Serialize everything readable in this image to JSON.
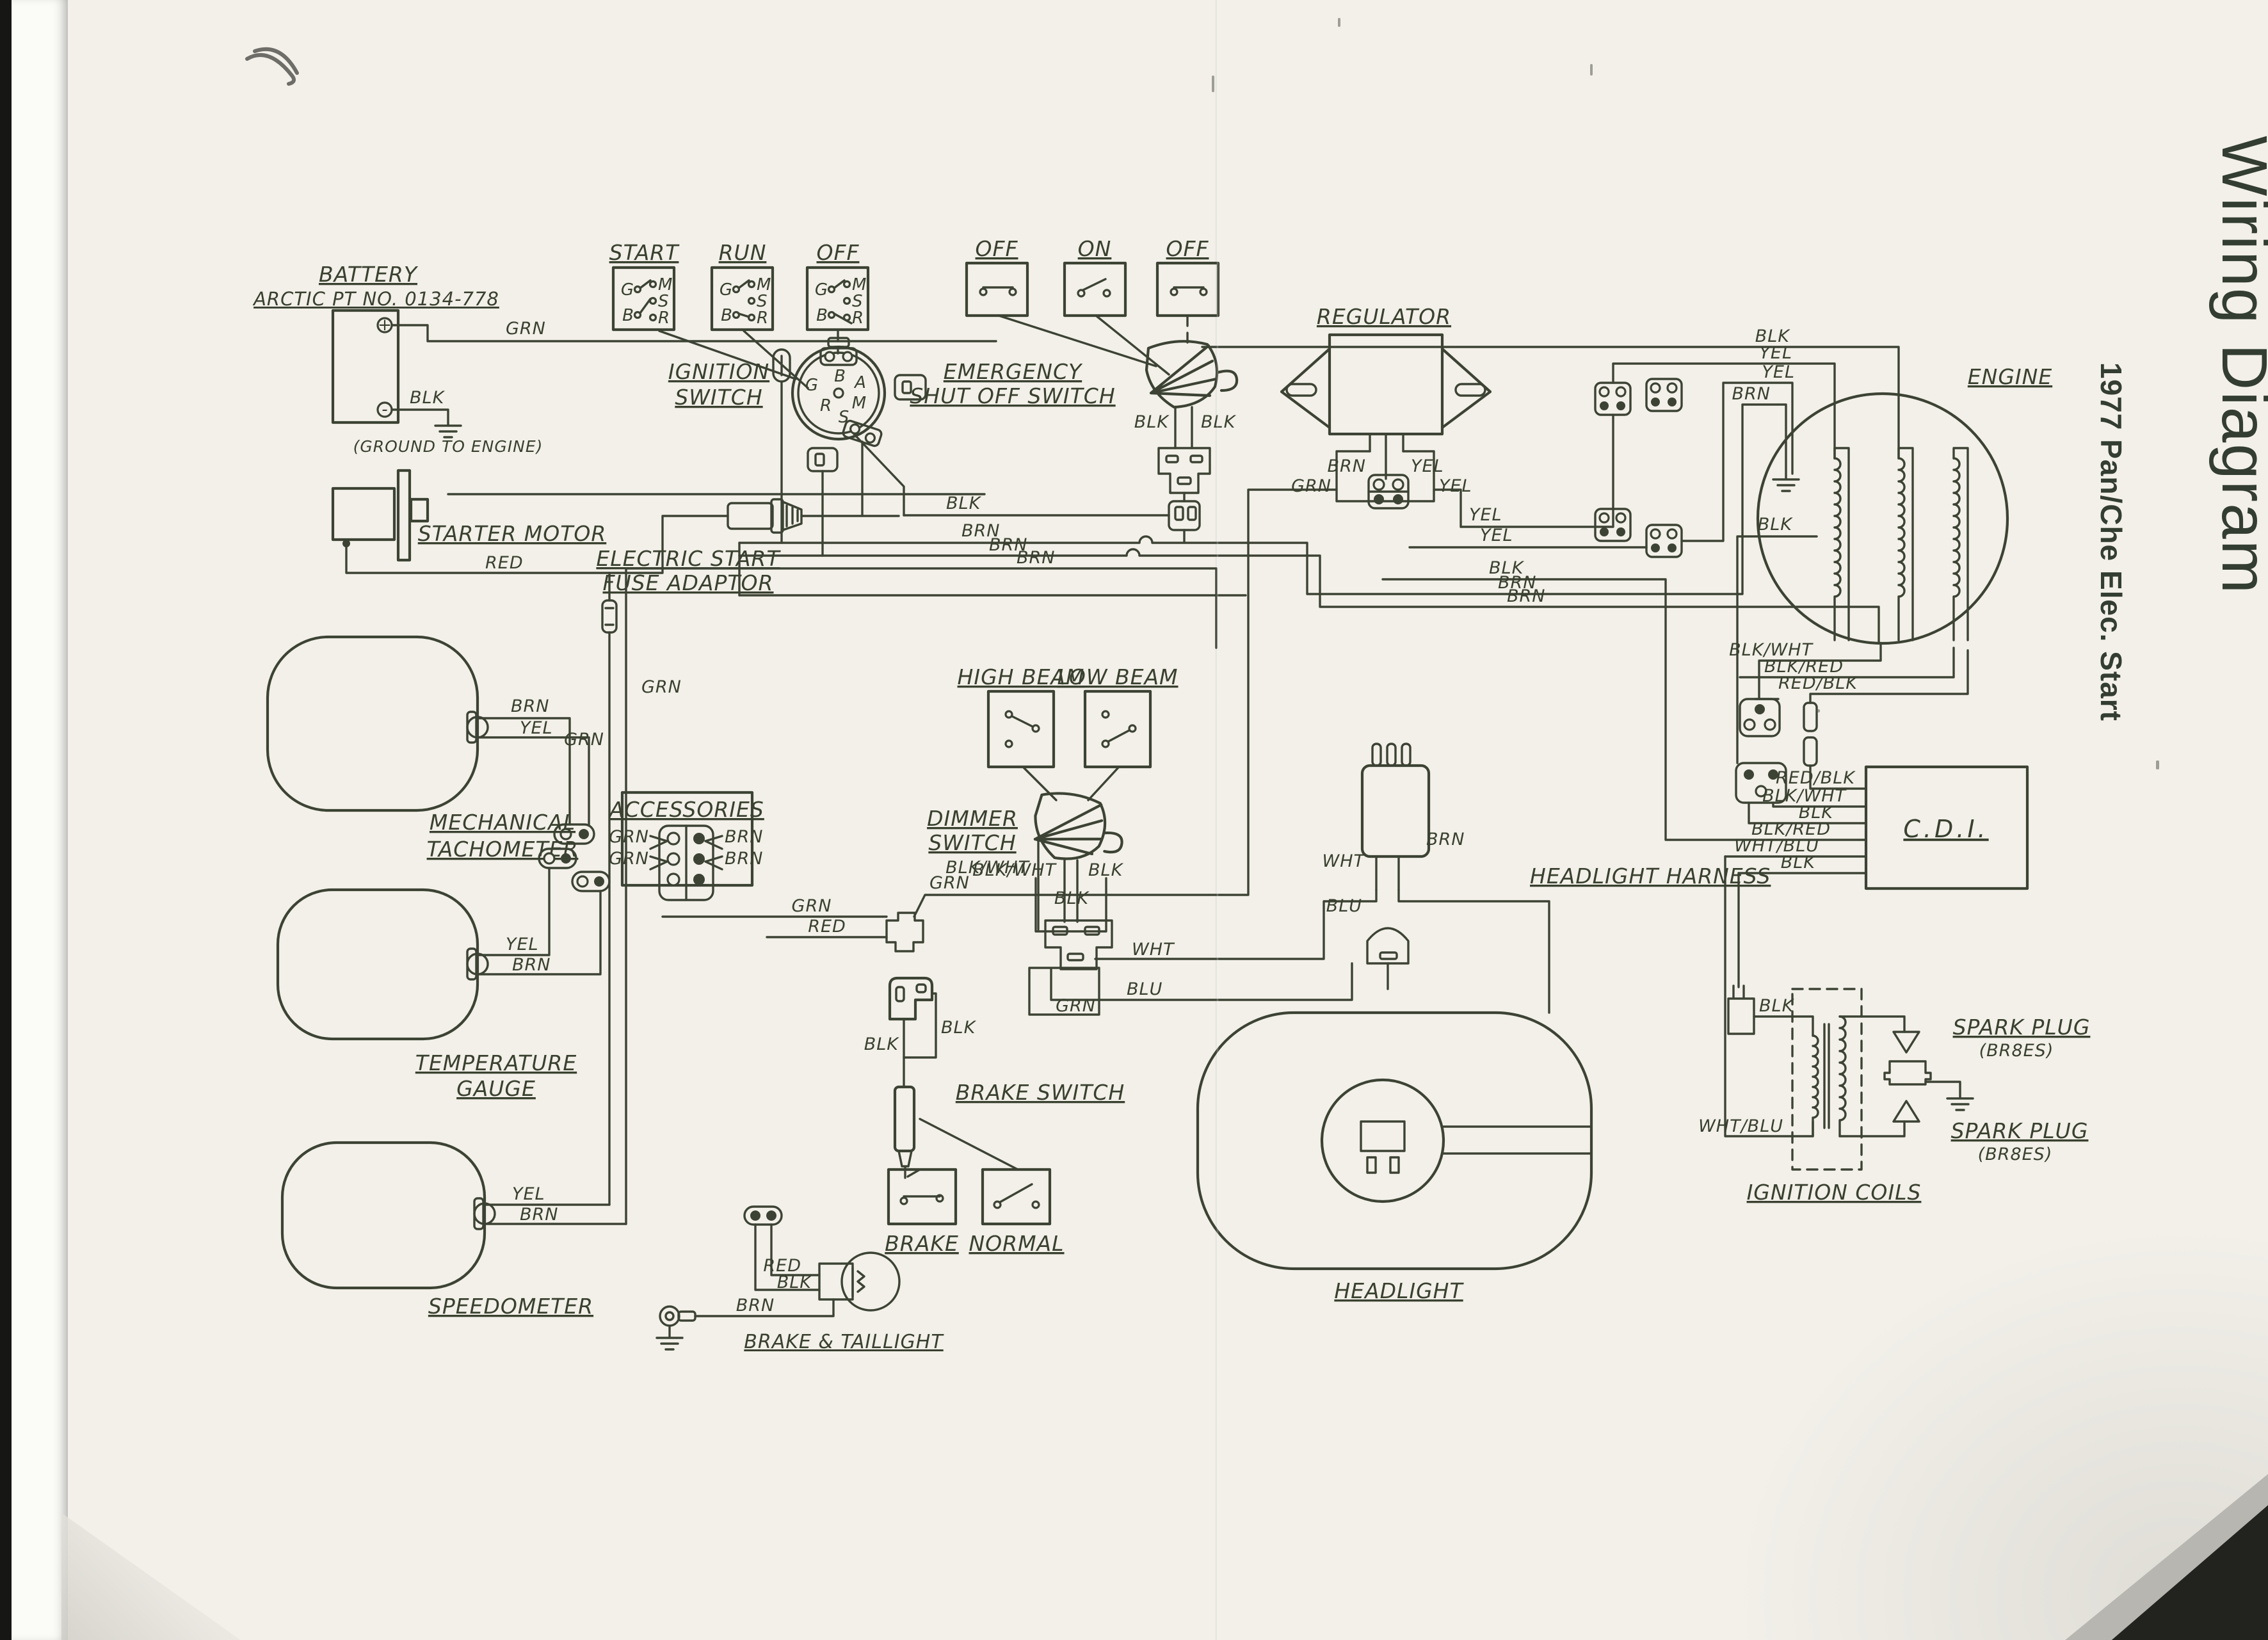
{
  "page": {
    "title_main": "Wiring Diagram",
    "title_sub": "1977 Pan/Che Elec. Start"
  },
  "battery": {
    "name": "BATTERY",
    "part": "ARCTIC PT NO. 0134-778",
    "plus": "+",
    "minus": "-",
    "wire_grn": "GRN",
    "wire_blk": "BLK",
    "ground_note": "(GROUND TO ENGINE)"
  },
  "key_positions": {
    "start": "START",
    "run": "RUN",
    "off": "OFF",
    "t_g": "G",
    "t_b": "B",
    "t_m": "M",
    "t_s": "S",
    "t_r": "R"
  },
  "ignition": {
    "line1": "IGNITION",
    "line2": "SWITCH",
    "t_b": "B",
    "t_g": "G",
    "t_a": "A",
    "t_m": "M",
    "t_r": "R",
    "t_s": "S"
  },
  "emergency": {
    "off1": "OFF",
    "on": "ON",
    "off2": "OFF",
    "line1": "EMERGENCY",
    "line2": "SHUT OFF SWITCH",
    "blk_l": "BLK",
    "blk_r": "BLK"
  },
  "starter": {
    "name": "STARTER MOTOR",
    "red": "RED"
  },
  "fuse_adaptor": {
    "line1": "ELECTRIC START",
    "line2": "FUSE ADAPTOR"
  },
  "regulator": {
    "name": "REGULATOR",
    "brn": "BRN",
    "yel_pin": "YEL",
    "grn": "GRN",
    "yel": "YEL"
  },
  "bundle": {
    "yel1": "YEL",
    "yel2": "YEL",
    "blk": "BLK",
    "brn1": "BRN",
    "brn2": "BRN"
  },
  "bus": {
    "blk": "BLK",
    "brn1": "BRN",
    "brn2": "BRN",
    "brn3": "BRN"
  },
  "engine": {
    "name": "ENGINE",
    "blk_top": "BLK",
    "yel1": "YEL",
    "yel2": "YEL",
    "brn": "BRN",
    "blk_low": "BLK"
  },
  "cdi": {
    "name": "C.D.I.",
    "up1": "BLK/WHT",
    "up2": "BLK/RED",
    "up3": "RED/BLK",
    "in1": "RED/BLK",
    "in2": "BLK/WHT",
    "in3": "BLK",
    "in4": "BLK/RED",
    "in5": "WHT/BLU",
    "in6": "BLK"
  },
  "coils": {
    "name": "IGNITION COILS",
    "blk": "BLK",
    "wht_blu": "WHT/BLU",
    "sp1a": "SPARK PLUG",
    "sp1b": "(BR8ES)",
    "sp2a": "SPARK PLUG",
    "sp2b": "(BR8ES)"
  },
  "tach": {
    "line1": "MECHANICAL",
    "line2": "TACHOMETER",
    "brn": "BRN",
    "yel": "YEL"
  },
  "temp": {
    "line1": "TEMPERATURE",
    "line2": "GAUGE",
    "yel": "YEL",
    "brn": "BRN"
  },
  "speedo": {
    "name": "SPEEDOMETER",
    "yel": "YEL",
    "brn": "BRN"
  },
  "left_bus": {
    "grn1": "GRN",
    "grn2": "GRN"
  },
  "accessories": {
    "name": "ACCESSORIES",
    "grn1": "GRN",
    "grn2": "GRN",
    "brn1": "BRN",
    "brn2": "BRN"
  },
  "mid": {
    "grn": "GRN",
    "red": "RED",
    "grn2": "GRN",
    "blk_wht": "BLK/WHT"
  },
  "dimmer": {
    "high": "HIGH BEAM",
    "low": "LOW BEAM",
    "line1": "DIMMER",
    "line2": "SWITCH",
    "blk_wht": "BLK/WHT",
    "blk_r": "BLK",
    "blk_c": "BLK",
    "wht": "WHT",
    "blu": "BLU",
    "grn": "GRN"
  },
  "headlight": {
    "name": "HEADLIGHT"
  },
  "harness": {
    "name": "HEADLIGHT HARNESS",
    "wht": "WHT",
    "brn": "BRN",
    "blu": "BLU"
  },
  "brake": {
    "name": "BRAKE SWITCH",
    "blk1": "BLK",
    "blk2": "BLK",
    "box1": "BRAKE",
    "box2": "NORMAL"
  },
  "taillight": {
    "name": "BRAKE & TAILLIGHT",
    "red": "RED",
    "blk": "BLK",
    "brn": "BRN"
  }
}
